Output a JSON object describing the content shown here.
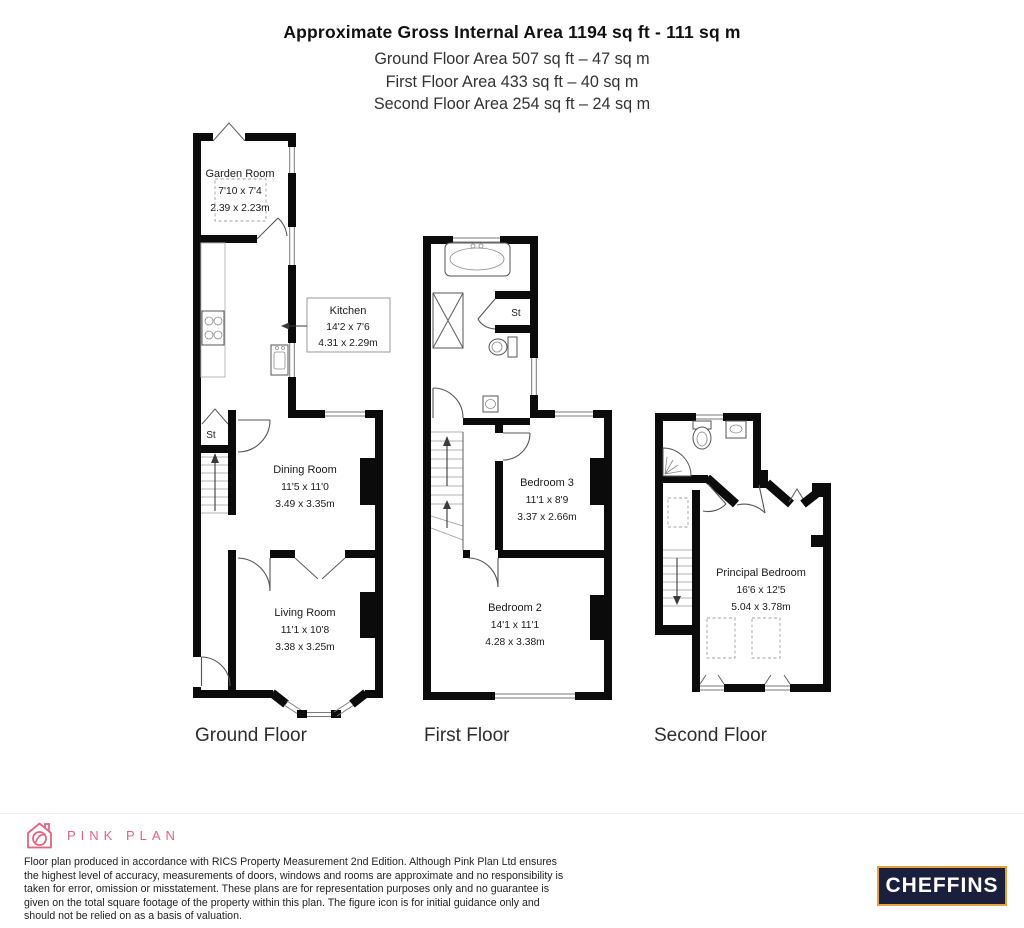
{
  "header": {
    "title": "Approximate Gross Internal Area 1194 sq ft - 111 sq m",
    "subtitle_lines": [
      "Ground Floor Area 507 sq ft – 47 sq m",
      "First Floor Area 433 sq ft – 40 sq m",
      "Second Floor Area 254 sq ft – 24 sq m"
    ]
  },
  "floors": {
    "ground": {
      "label": "Ground Floor",
      "rooms": {
        "garden_room": {
          "name": "Garden Room",
          "imperial": "7'10 x 7'4",
          "metric": "2.39 x 2.23m"
        },
        "kitchen": {
          "name": "Kitchen",
          "imperial": "14'2 x 7'6",
          "metric": "4.31 x 2.29m"
        },
        "dining_room": {
          "name": "Dining Room",
          "imperial": "11'5 x 11'0",
          "metric": "3.49 x 3.35m"
        },
        "living_room": {
          "name": "Living Room",
          "imperial": "11'1 x 10'8",
          "metric": "3.38 x 3.25m"
        },
        "store": "St"
      }
    },
    "first": {
      "label": "First Floor",
      "rooms": {
        "bedroom3": {
          "name": "Bedroom 3",
          "imperial": "11'1 x 8'9",
          "metric": "3.37 x 2.66m"
        },
        "bedroom2": {
          "name": "Bedroom 2",
          "imperial": "14'1 x 11'1",
          "metric": "4.28 x 3.38m"
        },
        "store": "St"
      }
    },
    "second": {
      "label": "Second Floor",
      "rooms": {
        "principal_bedroom": {
          "name": "Principal Bedroom",
          "imperial": "16'6 x 12'5",
          "metric": "5.04 x 3.78m"
        }
      }
    }
  },
  "footer": {
    "brand": "PINK PLAN",
    "disclaimer": "Floor plan produced in accordance with RICS Property Measurement 2nd Edition. Although Pink Plan Ltd ensures the highest level of accuracy, measurements of doors, windows and rooms are approximate and no responsibility is taken for error, omission or misstatement. These plans are for representation purposes only and no guarantee is given on the total square footage of the property within this plan. The figure icon is for initial guidance only and should not be relied on as a basis of valuation.",
    "agent_logo": "CHEFFINS"
  },
  "colors": {
    "wall": "#0b0b0b",
    "brand_pink": "#e4647e",
    "cheffins_navy": "#1b1f3e",
    "cheffins_gold": "#e3a23b"
  }
}
